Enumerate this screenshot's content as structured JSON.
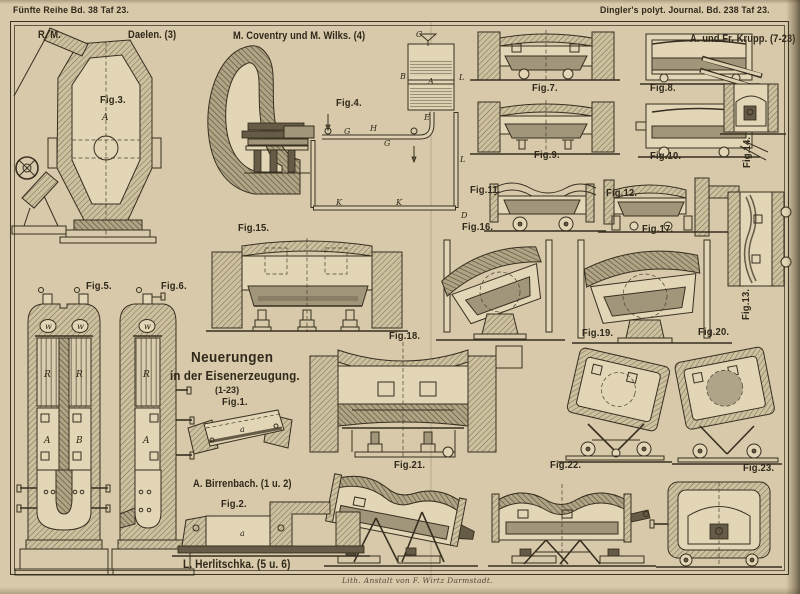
{
  "page": {
    "header_left": "Fünfte Reihe Bd. 38 Taf 23.",
    "header_right": "Dingler's polyt. Journal. Bd. 238 Taf 23.",
    "imprint": "Lith. Anstalt von F. Wirtz Darmstadt."
  },
  "title_block": {
    "line1": "Neuerungen",
    "line2": "in der Eisenerzeugung.",
    "range": "(1-23)"
  },
  "attributions": {
    "rm": "R. M.",
    "daelen": "Daelen. (3)",
    "coventry_wilks": "M. Coventry und M. Wilks. (4)",
    "krupp": "A. und Fr. Krupp. (7-23)",
    "birrenbach": "A. Birrenbach. (1 u. 2)",
    "herlitschka": "L. Herlitschka. (5 u. 6)"
  },
  "figure_labels": {
    "fig1": "Fig.1.",
    "fig2": "Fig.2.",
    "fig3": "Fig.3.",
    "fig4": "Fig.4.",
    "fig5": "Fig.5.",
    "fig6": "Fig.6.",
    "fig7": "Fig.7.",
    "fig8": "Fig.8.",
    "fig9": "Fig.9.",
    "fig10": "Fig.10.",
    "fig11": "Fig.11.",
    "fig12": "Fig.12.",
    "fig13": "Fig.13.",
    "fig14": "Fig.14.",
    "fig15": "Fig.15.",
    "fig16": "Fig.16.",
    "fig17": "Fig.17.",
    "fig18": "Fig.18.",
    "fig19": "Fig.19.",
    "fig20": "Fig.20.",
    "fig21": "Fig.21.",
    "fig22": "Fig.22.",
    "fig23": "Fig.23."
  },
  "letters": {
    "fig1": [
      "a"
    ],
    "fig2": [
      "a"
    ],
    "fig3": [
      "A"
    ],
    "fig4": [
      "C",
      "B",
      "A",
      "L",
      "E",
      "G",
      "H",
      "G",
      "K",
      "K",
      "L",
      "D"
    ],
    "fig5": [
      "w",
      "w",
      "R",
      "R",
      "A",
      "B"
    ],
    "fig6": [
      "w",
      "R",
      "A"
    ]
  },
  "colors": {
    "paper": "#d7c9a9",
    "ink": "#372f20",
    "wall_shade": "#b1a485",
    "dark_fill": "#655b46"
  }
}
